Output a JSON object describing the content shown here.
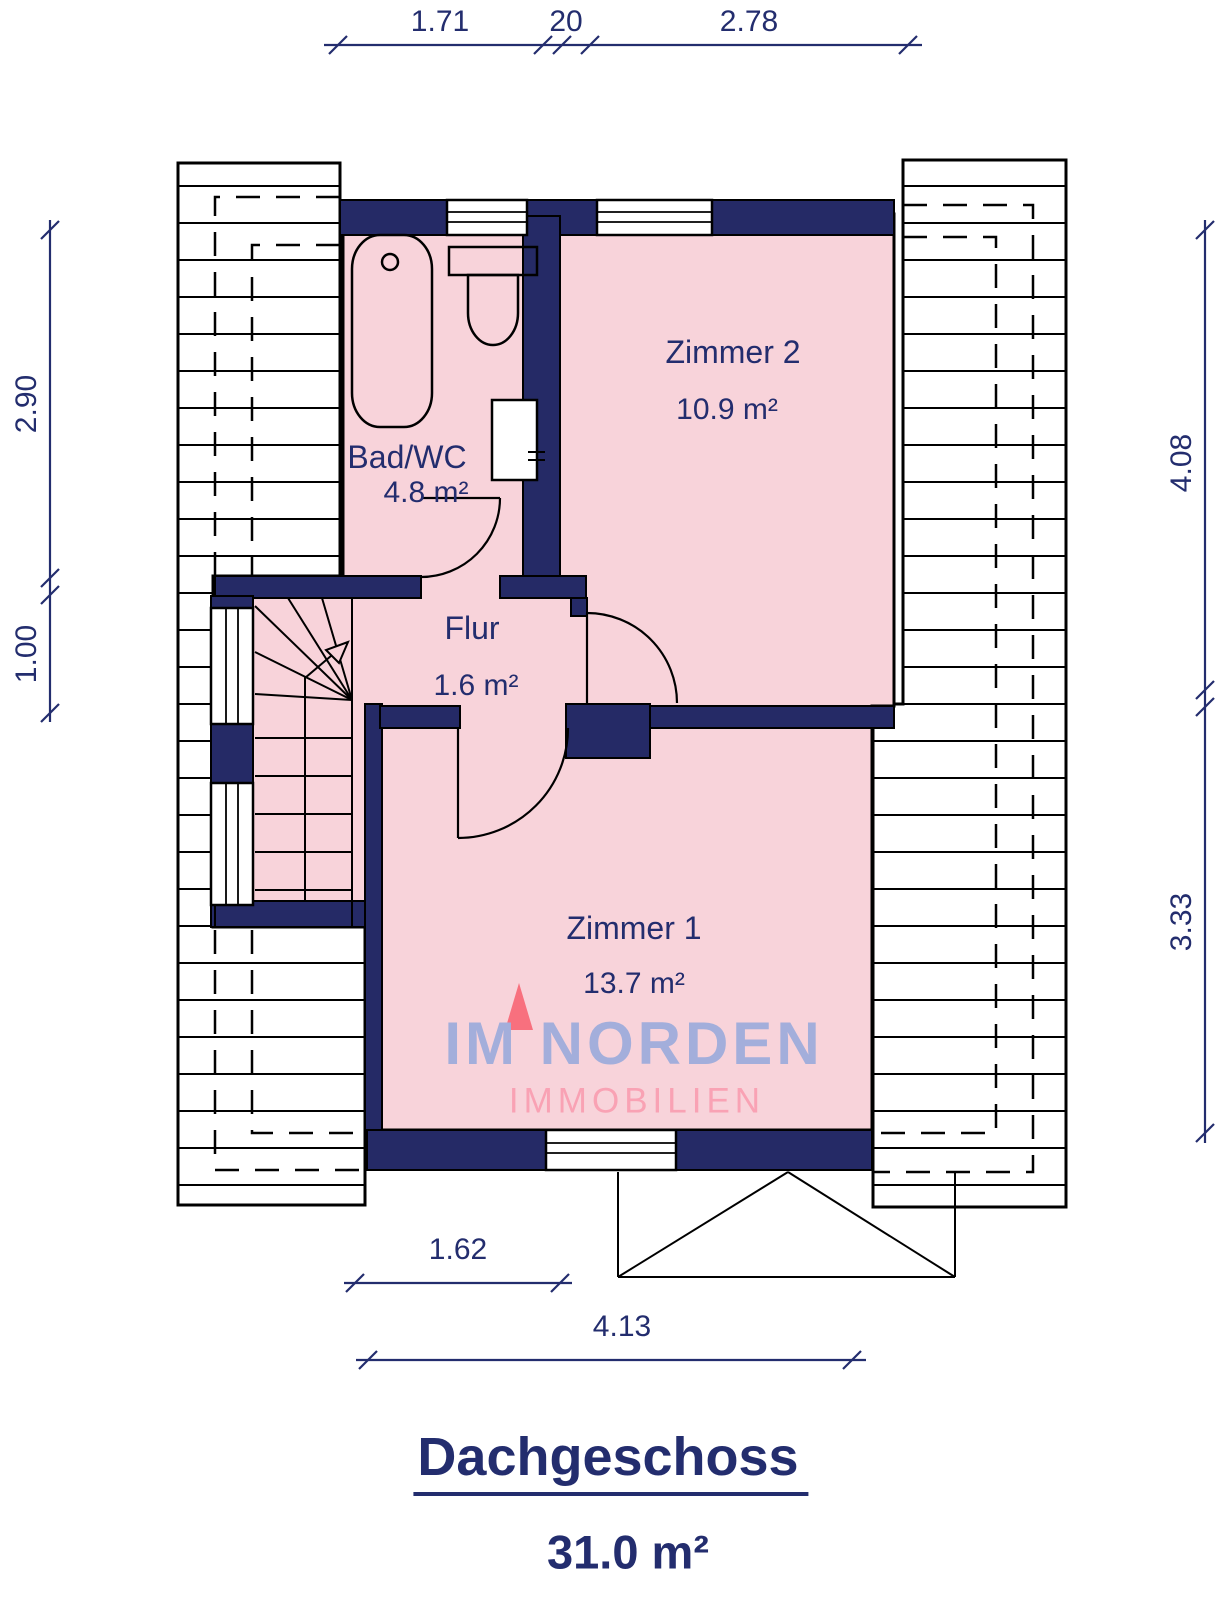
{
  "floorplan": {
    "title": "Dachgeschoss",
    "total_area": "31.0 m²",
    "rooms": [
      {
        "name": "Bad/WC",
        "area": "4.8 m²"
      },
      {
        "name": "Zimmer 2",
        "area": "10.9 m²"
      },
      {
        "name": "Flur",
        "area": "1.6 m²"
      },
      {
        "name": "Zimmer 1",
        "area": "13.7 m²"
      }
    ],
    "dimensions": {
      "top": [
        "1.71",
        "20",
        "2.78"
      ],
      "left": [
        "2.90",
        "1.00"
      ],
      "right": [
        "4.08",
        "3.33"
      ],
      "bottom": [
        "1.62",
        "4.13"
      ]
    },
    "watermark": {
      "line1": "IM NORDEN",
      "line2": "IMMOBILIEN"
    },
    "colors": {
      "wall_navy": "#252a66",
      "room_pink": "#f8d3da",
      "text_navy": "#232d6e",
      "watermark_blue": "#a3aedb",
      "watermark_pink": "#f9a2b4",
      "logo_red": "#f8707e"
    }
  }
}
